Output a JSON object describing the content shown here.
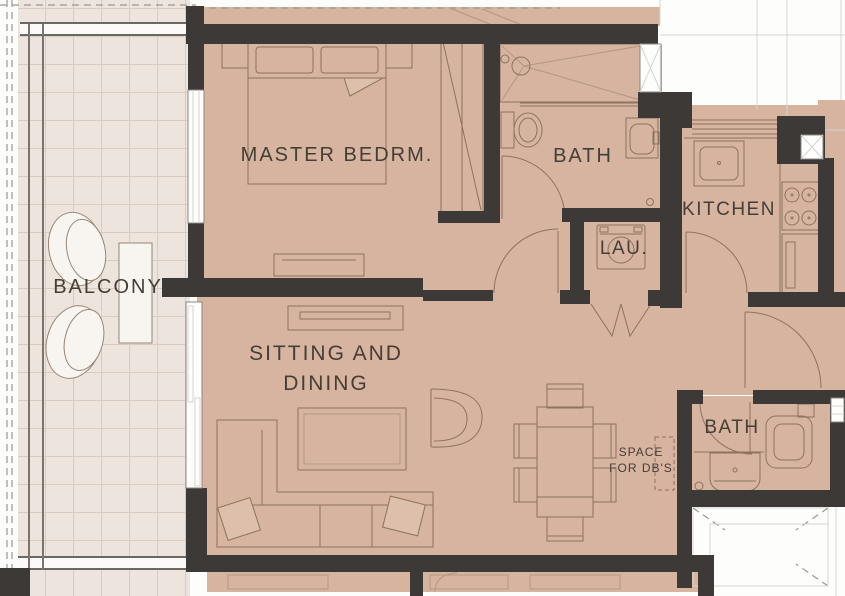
{
  "plan": {
    "rooms": {
      "balcony": "BALCONY",
      "master_bedroom": "MASTER BEDRM.",
      "bath_top": "BATH",
      "kitchen": "KITCHEN",
      "laundry": "LAU.",
      "sitting_dining_line1": "SITTING AND",
      "sitting_dining_line2": "DINING",
      "bath_bottom": "BATH",
      "db_space_line1": "SPACE",
      "db_space_line2": "FOR DB'S"
    },
    "colors": {
      "unit_floor": "#d7b4a0",
      "balcony_floor": "#ece4dd",
      "wall": "#3c3936",
      "furniture_line": "#8d7260",
      "outside": "#fdfdfc"
    }
  }
}
